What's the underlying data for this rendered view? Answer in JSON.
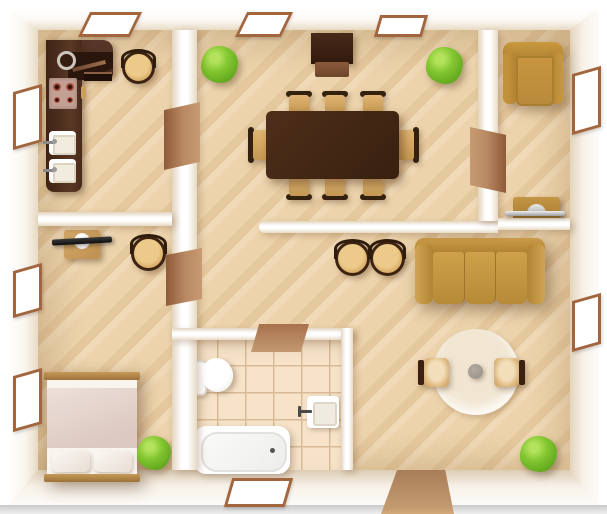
{
  "scene": {
    "title": "Apartment floor plan, top-down pseudo-3D view",
    "view": "top-down",
    "text_visible": false
  },
  "palette": {
    "wall-shade": "#e8dbc6",
    "floor-base": "#ecd3ab",
    "floor-stripe": "#e5c99e",
    "tile-base": "#f6e3c9",
    "tile-grout": "#d8ba97",
    "window-frame": "#a2653e",
    "wood-dark": "#45281a",
    "wood-mid": "#b5854a",
    "sofa-gold": "#c89d4e",
    "seat-tan": "#d9ad67",
    "plant-green": "#82c630",
    "rug-cream": "#f4ecdb",
    "door-brown": "#b07c55",
    "metal-gray": "#c2c2c2"
  },
  "rooms": [
    {
      "name": "kitchen",
      "position": "top-left",
      "furniture": [
        "l-shaped-counter",
        "corner-cabinet",
        "round-sink",
        "stove-four-burners",
        "sink-unit",
        "sink-unit",
        "stool"
      ],
      "windows": 2,
      "doors": 1
    },
    {
      "name": "dining-room",
      "position": "top-center",
      "furniture": [
        "sideboard-cabinet",
        "dining-table",
        "chair",
        "chair",
        "chair",
        "chair",
        "chair",
        "chair",
        "chair",
        "chair",
        "plant",
        "plant"
      ],
      "windows": 2,
      "doors": 2
    },
    {
      "name": "study",
      "position": "top-right",
      "furniture": [
        "armchair",
        "console-table"
      ],
      "windows": 1,
      "doors": 1
    },
    {
      "name": "bedroom",
      "position": "left",
      "furniture": [
        "desk",
        "tv",
        "stool",
        "double-bed",
        "pillow",
        "pillow",
        "plant"
      ],
      "windows": 2,
      "doors": 1
    },
    {
      "name": "bathroom",
      "position": "bottom-center",
      "furniture": [
        "toilet",
        "washbasin",
        "bathtub"
      ],
      "windows": 1,
      "doors": 1
    },
    {
      "name": "living-room",
      "position": "right",
      "furniture": [
        "sofa-three-seat",
        "stool",
        "stool",
        "round-rug",
        "coffee-table",
        "chair",
        "chair",
        "plant"
      ],
      "windows": 1,
      "doors": 1
    }
  ]
}
